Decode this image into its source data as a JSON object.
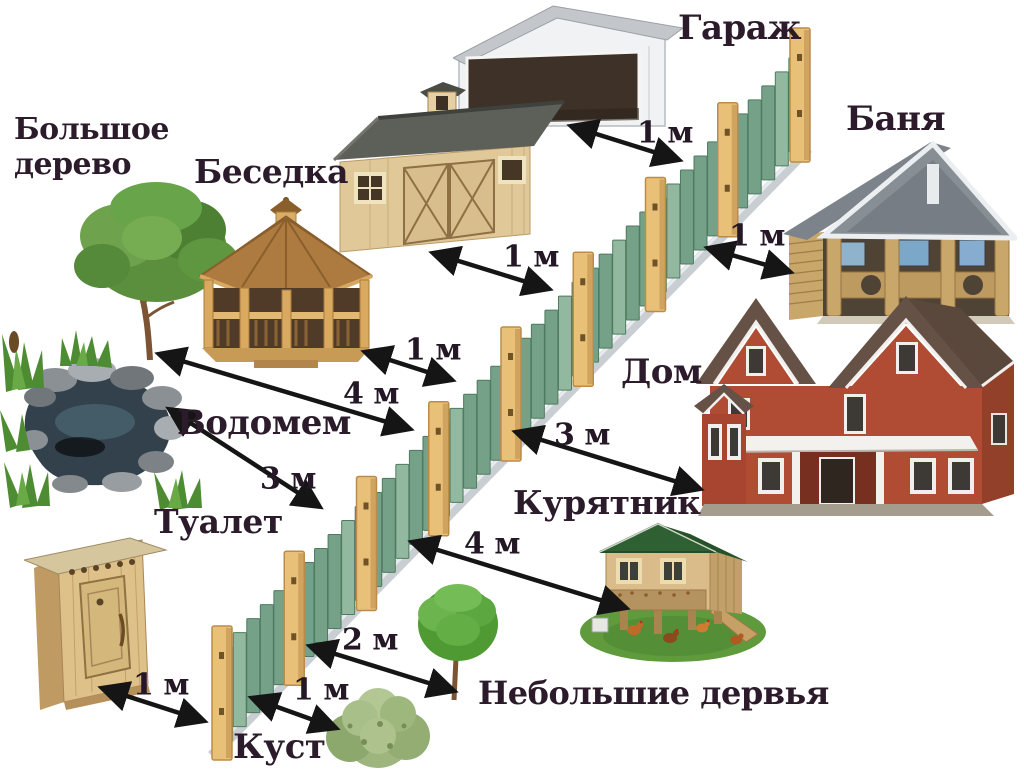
{
  "title": "Нормы расстояний построек от забора",
  "labels": {
    "garage": "Гараж",
    "banya": "Баня",
    "big_tree": "Большое дерево",
    "gazebo": "Беседка",
    "pond": "Водомем",
    "house": "Дом",
    "coop": "Курятник",
    "toilet": "Туалет",
    "small_trees": "Небольшие дервья",
    "bush": "Куст"
  },
  "distances": {
    "garage": "1 м",
    "shed": "1 м",
    "banya": "1 м",
    "gazebo": "1 м",
    "big_tree": "4 м",
    "pond": "3 м",
    "house": "3 м",
    "coop": "4 м",
    "small_trees": "2 м",
    "bush": "1 м",
    "toilet": "1 м"
  },
  "colors": {
    "background": "#ffffff",
    "label_text": "#2c1c2b",
    "arrow": "#151515",
    "fence_picket": "#74a187",
    "fence_picket_light": "#92b99f",
    "fence_picket_dark": "#4e7a60",
    "fence_post": "#e9c078",
    "fence_post_shadow": "#bb8c49",
    "fence_rail": "#c9ced2"
  }
}
